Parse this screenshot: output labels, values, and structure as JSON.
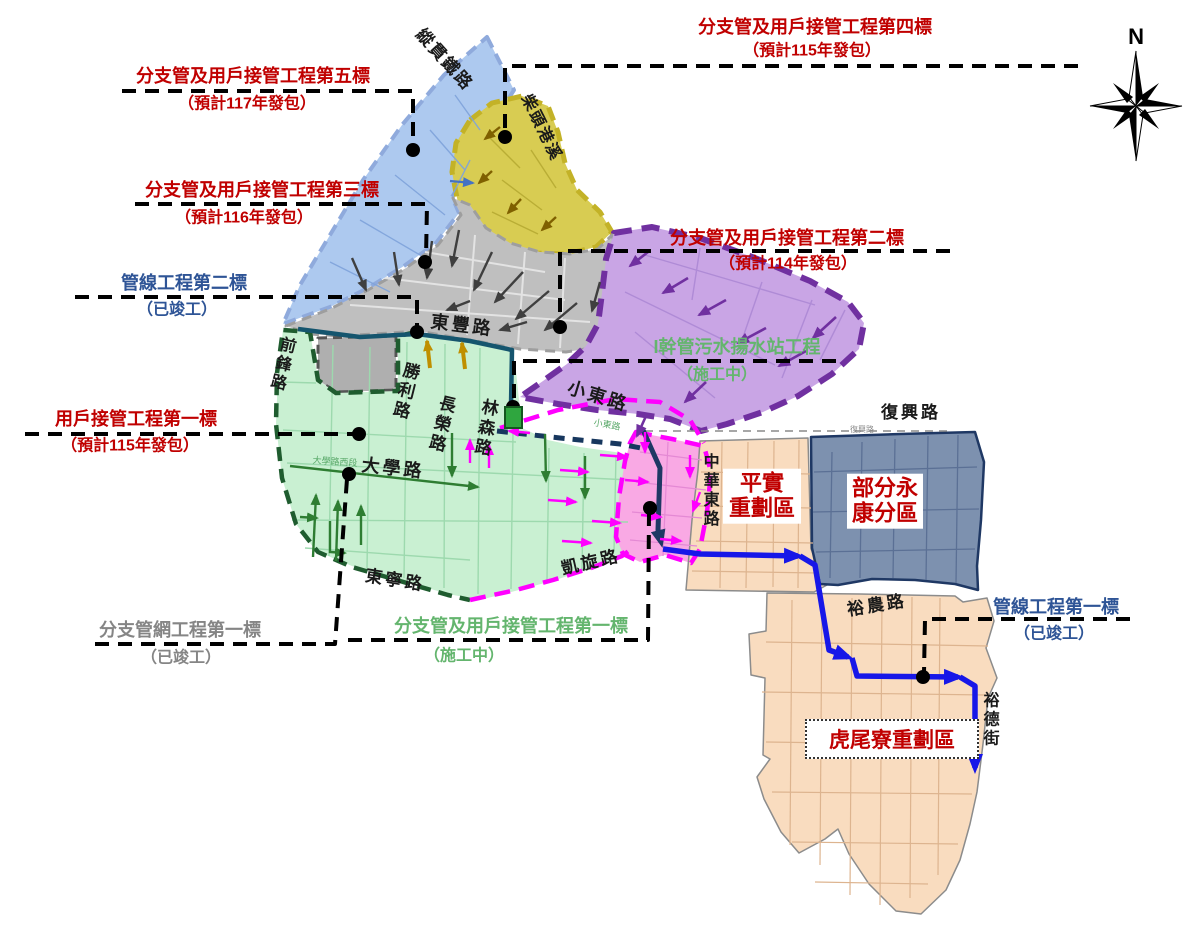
{
  "colors": {
    "label_red": "#C00000",
    "label_blue": "#2E5496",
    "label_green": "#64B56E",
    "label_gray": "#858585",
    "road_black": "#1a1a1a",
    "road_small": "#8a8a8a",
    "road_small_green": "#56A766",
    "zone_blue": "#ADC9EF",
    "zone_blue_border": "#8FAADC",
    "zone_yellow": "#D8CC52",
    "zone_yellow_border": "#C3B227",
    "zone_gray": "#BFBFBF",
    "zone_gray_dark": "#AFAFAF",
    "zone_gray_border": "#9E9E9E",
    "zone_annex_border": "#555555",
    "zone_purple": "#C9A5E5",
    "zone_purple_border": "#7030A0",
    "zone_green": "#C9F0D2",
    "zone_green_border": "#1F5C2F",
    "zone_pink": "#F9A9E4",
    "zone_pink_border": "#FF00FF",
    "zone_orange": "#F9DCBF",
    "zone_orange_border": "#8C8C8C",
    "zone_slate": "#7D91AF",
    "zone_slate_border": "#1F3864",
    "line_royal": "#1717E8",
    "line_navy": "#1F3864",
    "line_navy_dash": "#17375E",
    "line_teal": "#15556E",
    "arrow_gray": "#3F3F3F",
    "arrow_olive": "#7F6000",
    "arrow_purple": "#7030A0",
    "arrow_green": "#2E7D32",
    "arrow_magenta": "#FF00FF",
    "arrow_tan": "#BF8F00",
    "arrow_blue": "#4472C4",
    "leader_black": "#000000",
    "pump_green": "#2FA63F",
    "pump_border": "#14571F",
    "street_blue": "#7FA3DB",
    "street_yellow": "#B9AD35",
    "street_gray": "#E3E3E3",
    "street_purple": "#AF8BD6",
    "street_green": "#9DD9AE",
    "street_pink": "#E489D4",
    "street_orange": "#DDB48F",
    "street_slate": "#5B7095"
  },
  "projects": {
    "branch5": {
      "name": "分支管及用戶接管工程第五標",
      "status": "（預計117年發包）"
    },
    "branch4": {
      "name": "分支管及用戶接管工程第四標",
      "status": "（預計115年發包）"
    },
    "branch3": {
      "name": "分支管及用戶接管工程第三標",
      "status": "（預計116年發包）"
    },
    "branch2": {
      "name": "分支管及用戶接管工程第二標",
      "status": "（預計114年發包）"
    },
    "branch1": {
      "name": "分支管及用戶接管工程第一標",
      "status": "（施工中）"
    },
    "pipe2": {
      "name": "管線工程第二標",
      "status": "（已竣工）"
    },
    "pipe1": {
      "name": "管線工程第一標",
      "status": "（已竣工）"
    },
    "net1": {
      "name": "分支管網工程第一標",
      "status": "（已竣工）"
    },
    "user1": {
      "name": "用戶接管工程第一標",
      "status": "（預計115年發包）"
    },
    "pump": {
      "name": "I幹管污水揚水站工程",
      "status": "（施工中）"
    }
  },
  "regions": {
    "pingshi": {
      "line1": "平實",
      "line2": "重劃區"
    },
    "yongkang": {
      "line1": "部分永",
      "line2": "康分區"
    },
    "huweiliao": {
      "name": "虎尾寮重劃區"
    }
  },
  "roads": {
    "railway": "縱貫鐵路",
    "creek": "柴頭港溪",
    "dongfeng": "東豐路",
    "xiaodong": "小東路",
    "xiaodong_small": "小東路",
    "qianfeng": "前鋒路",
    "shengli": "勝利路",
    "changrong": "長榮路",
    "linsen": "林森路",
    "daxue": "大學路",
    "daxue_west": "大學路西段",
    "dongning": "東寧路",
    "kaixuan": "凱旋路",
    "zhonghua": "中華東路",
    "fuxing": "復興路",
    "fuxing_small": "復興路",
    "yunong": "裕農路",
    "yude": "裕德街"
  },
  "compass": {
    "north": "N"
  }
}
